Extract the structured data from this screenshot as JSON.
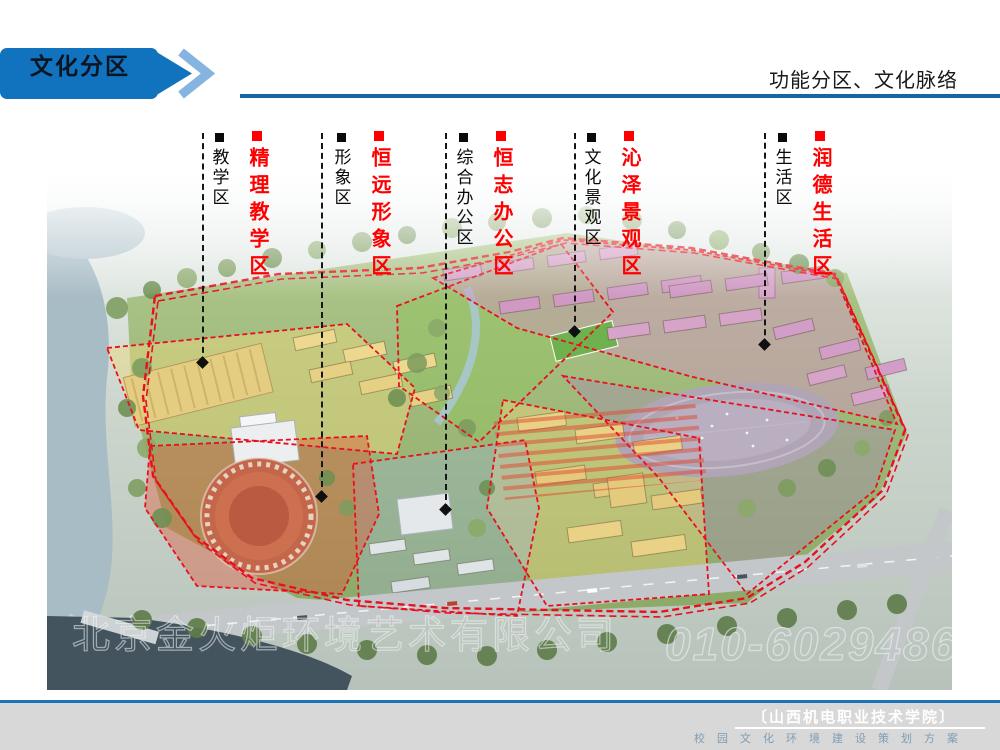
{
  "header": {
    "banner_label": "文化分区",
    "right_title": "功能分区、文化脉络",
    "banner_color": "#1173bd",
    "chevron_color": "#85b4e0",
    "rule_color": "#1565a9"
  },
  "zones": [
    {
      "category": "教学区",
      "brand_name": "精理教学区"
    },
    {
      "category": "形象区",
      "brand_name": "恒远形象区"
    },
    {
      "category": "综合办公区",
      "brand_name": "恒志办公区"
    },
    {
      "category": "文化景观区",
      "brand_name": "沁泽景观区"
    },
    {
      "category": "生活区",
      "brand_name": "润德生活区"
    }
  ],
  "label_colors": {
    "category_bullet": "#0a0a0a",
    "brand_bullet": "#fe0000",
    "brand_text": "#fe0000"
  },
  "watermark": {
    "company": "北京金火炬环境艺术有限公司",
    "phone": "010-60294863"
  },
  "footer": {
    "institution": "〔山西机电职业技术学院〕",
    "subtitle": "校园文化环境建设策划方案",
    "bar_color": "#d8d8d8",
    "line_color": "#1c73b4"
  }
}
